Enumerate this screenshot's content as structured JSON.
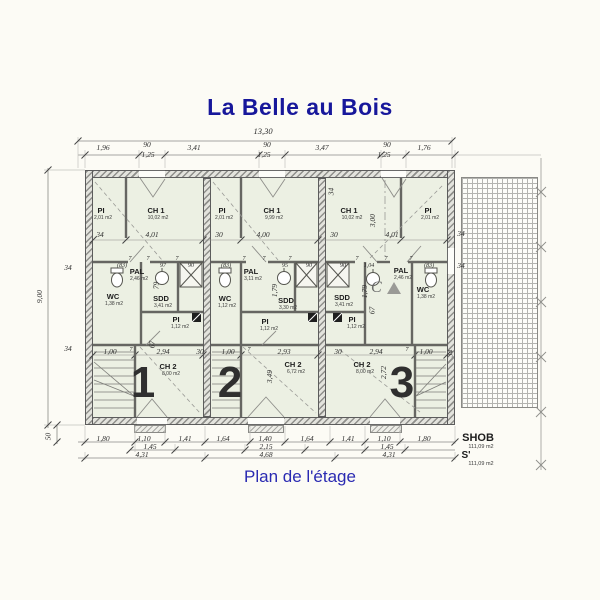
{
  "title": "La Belle au Bois",
  "caption": "Plan de l'étage",
  "colors": {
    "accent_blue": "#17179b",
    "room_fill": "#ecf0e3",
    "wall_gray": "#8f8f8b"
  },
  "overall": {
    "total_width": "13,30",
    "total_height": "9,00",
    "bottom_offset": "50"
  },
  "top_row": [
    "1,96",
    "90",
    "3,41",
    "90",
    "3,47",
    "90",
    "1,76"
  ],
  "top_sub": [
    "1,25",
    "1,25",
    "1,25"
  ],
  "left_side": [
    "34",
    "34"
  ],
  "right_side": [
    "34",
    "34"
  ],
  "inner_top": [
    "34",
    "4,01",
    "30",
    "4,00",
    "30",
    "4,01"
  ],
  "bottom_r1": [
    "1,80",
    "1,10",
    "1,41",
    "1,64",
    "1,40",
    "1,64",
    "1,41",
    "1,10",
    "1,80"
  ],
  "bottom_r2": [
    "1,45",
    "2,15",
    "1,45"
  ],
  "bottom_r3": [
    "4,31",
    "4,68",
    "4,31"
  ],
  "summary": {
    "shob_label": "SHOB",
    "shob_area": "111,09 m2",
    "s_label": "S'",
    "s_area": "111,09 m2"
  },
  "units": [
    {
      "number": "1",
      "rooms": {
        "pi_top": {
          "name": "PI",
          "area": "2,01 m2"
        },
        "ch1": {
          "name": "CH 1",
          "area": "10,02 m2"
        },
        "wc": {
          "name": "WC",
          "area": "1,38 m2"
        },
        "pal": {
          "name": "PAL",
          "area": "2,46 m2"
        },
        "sdd": {
          "name": "SDD",
          "area": "3,41 m2"
        },
        "pi": {
          "name": "PI",
          "area": "1,12 m2"
        },
        "ch2": {
          "name": "CH 2",
          "area": "8,00 m2"
        }
      },
      "dims": {
        "band": [
          "(83)",
          "97",
          "90"
        ],
        "sevens": [
          "7",
          "7",
          "7"
        ],
        "v1": "79",
        "v2": "67",
        "low": [
          "1,00",
          "7",
          "2,94",
          "30"
        ]
      }
    },
    {
      "number": "2",
      "rooms": {
        "pi_top": {
          "name": "PI",
          "area": "2,01 m2"
        },
        "ch1": {
          "name": "CH 1",
          "area": "9,99 m2"
        },
        "wc": {
          "name": "WC",
          "area": "1,12 m2"
        },
        "pal": {
          "name": "PAL",
          "area": "3,11 m2"
        },
        "sdd": {
          "name": "SDD",
          "area": "3,30 m2"
        },
        "pi": {
          "name": "PI",
          "area": "1,12 m2"
        },
        "ch2": {
          "name": "CH 2",
          "area": "6,72 m2"
        }
      },
      "dims": {
        "band": [
          "(83)",
          "95",
          "90"
        ],
        "sevens": [
          "7",
          "7",
          "7"
        ],
        "v1": "1,79",
        "ch2_v": "3,49",
        "low": [
          "1,00",
          "7",
          "2,93",
          "30"
        ]
      }
    },
    {
      "number": "3",
      "rooms": {
        "ch1": {
          "name": "CH 1",
          "area": "10,02 m2"
        },
        "pi_top": {
          "name": "PI",
          "area": "2,01 m2"
        },
        "sdd": {
          "name": "SDD",
          "area": "3,41 m2"
        },
        "pal": {
          "name": "PAL",
          "area": "2,46 m2"
        },
        "wc": {
          "name": "WC",
          "area": "1,38 m2"
        },
        "pi": {
          "name": "PI",
          "area": "1,12 m2"
        },
        "ch2": {
          "name": "CH 2",
          "area": "8,00 m2"
        }
      },
      "dims": {
        "band": [
          "90",
          "1,04",
          "(83)"
        ],
        "sevens": [
          "7",
          "7",
          "7"
        ],
        "v1": "1,79",
        "v2": "67",
        "v3": "3,00",
        "v34": "34",
        "low34": "34",
        "ch2_v": "2,72",
        "low": [
          "2,94",
          "7",
          "1,00"
        ],
        "section": "C"
      }
    }
  ]
}
